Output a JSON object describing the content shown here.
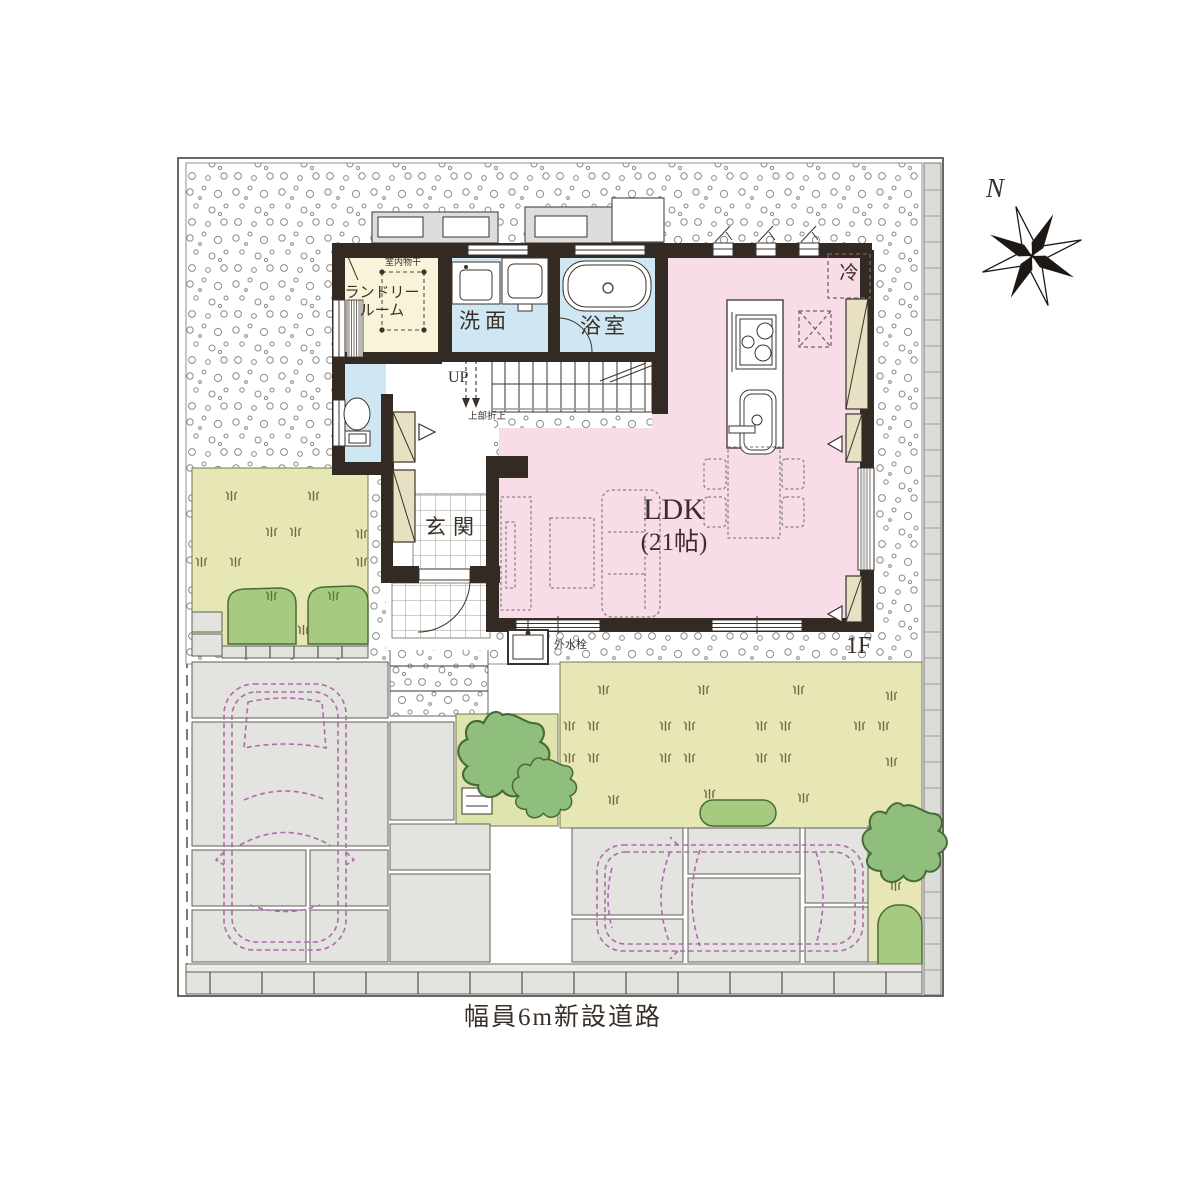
{
  "labels": {
    "laundry_line1": "ランドリー",
    "laundry_line2": "ルーム",
    "indoor_drying": "室内物干",
    "washroom": "洗面",
    "bathroom": "浴室",
    "up": "UP",
    "ceiling_note": "上部折上",
    "entrance": "玄関",
    "ldk_name": "LDK",
    "ldk_size": "(21帖)",
    "fridge": "冷",
    "water_tap": "外水栓",
    "floor": "1F",
    "road": "幅員6m新設道路",
    "compass_north": "N"
  },
  "colors": {
    "wall": "#332a24",
    "ldk_floor": "#f8dce8",
    "wet_floor": "#cfe7f2",
    "laundry_floor": "#f8f3d9",
    "cabinet": "#e8e0c2",
    "lawn": "#e6e7b4",
    "lawn_light": "#dfe3ac",
    "foliage": "#8fbe7d",
    "bush": "#a6cb80",
    "paving": "#e3e3df",
    "car_outline": "#b169ad",
    "ink": "#3a3028"
  }
}
